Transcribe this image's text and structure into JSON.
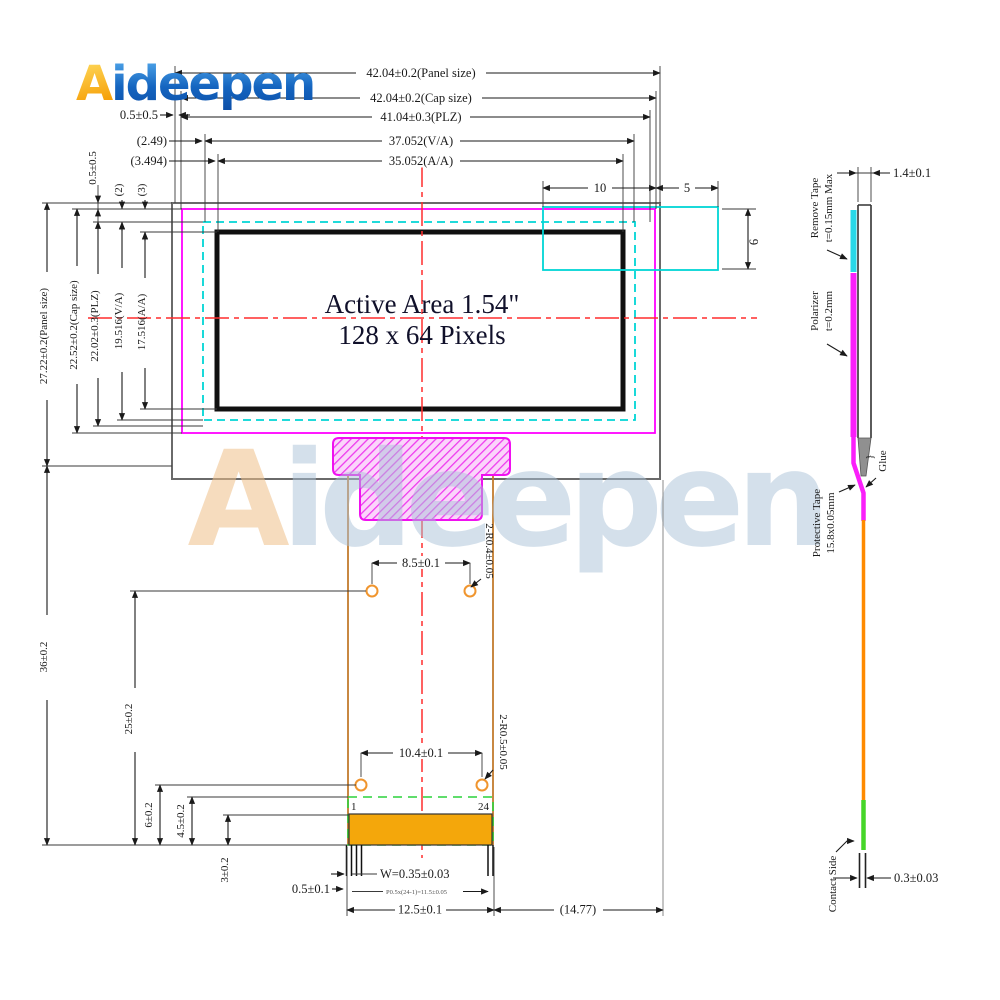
{
  "logo": {
    "a": "A",
    "rest": "ideepen"
  },
  "watermark": {
    "a": "A",
    "rest": "ideepen"
  },
  "active_area": {
    "line1": "Active Area 1.54\"",
    "line2": "128 x 64 Pixels"
  },
  "pins": {
    "first": "1",
    "last": "24"
  },
  "dims": {
    "top": {
      "panel": "42.04±0.2(Panel size)",
      "cap": "42.04±0.2(Cap size)",
      "plz": "41.04±0.3(PLZ)",
      "va": "37.052(V/A)",
      "aa": "35.052(A/A)",
      "off05": "0.5±0.5",
      "off249": "(2.49)",
      "off3494": "(3.494)",
      "d10": "10",
      "d5": "5",
      "d6": "6"
    },
    "left": {
      "panel_h": "27.22±0.2(Panel size)",
      "cap_h": "22.52±0.2(Cap size)",
      "plz_h": "22.02±0.3(PLZ)",
      "va_h": "19.516(V/A)",
      "aa_h": "17.516(A/A)",
      "off05v": "0.5±0.5",
      "off2": "(2)",
      "off3": "(3)",
      "len36": "36±0.2",
      "len25": "25±0.2",
      "len6": "6±0.2",
      "len45": "4.5±0.2",
      "len3": "3±0.2"
    },
    "fpc": {
      "d85": "8.5±0.1",
      "r04": "2-R0.4±0.05",
      "d104": "10.4±0.1",
      "r05": "2-R0.5±0.05",
      "d05": "0.5±0.1",
      "w": "W=0.35±0.03",
      "pitch": "P0.5x(24-1)=11.5±0.05",
      "d125": "12.5±0.1",
      "d1477": "(14.77)"
    },
    "side": {
      "d14": "1.4±0.1",
      "rt1": "Remove Tape",
      "rt2": "t=0.15mm Max",
      "pol1": "Polarizer",
      "pol2": "t=0.2mm",
      "glue": "Glue",
      "glue_brace": "}",
      "pt1": "Protective Tape",
      "pt2": "15.8x0.05mm",
      "contact": "Contact Side",
      "d03": "0.3±0.03"
    }
  },
  "colors": {
    "panel_outline": "#6a6a6a",
    "cap_outline": "#ff00ff",
    "polarizer_outline": "#00d5d5",
    "active_border": "#101010",
    "centerline_red": "#ff2d2d",
    "fpc_brown": "#c27b2e",
    "pad_orange": "#f4a70b",
    "contact_green": "#2bd23b",
    "hole_ring": "#f0952e",
    "logo_blue": "#0b4da6",
    "logo_orange": "#f59a00"
  }
}
